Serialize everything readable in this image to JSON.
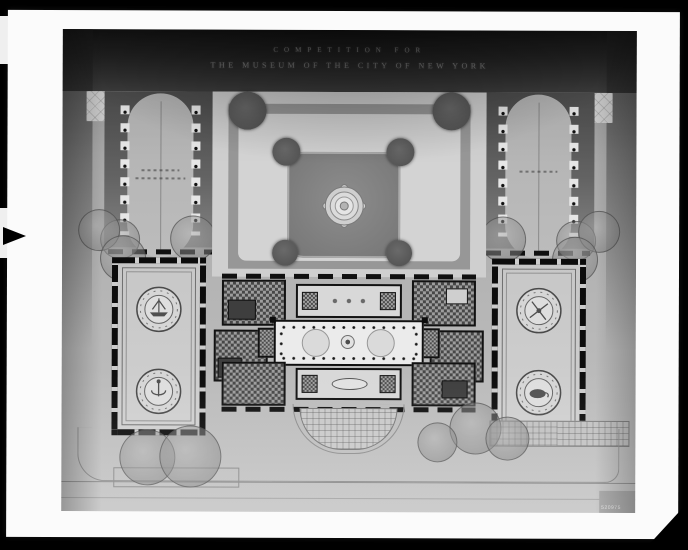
{
  "photo": {
    "title_line1": "COMPETITION FOR",
    "title_line2": "THE MUSEUM OF THE CITY OF NEW YORK",
    "catalog_number": "520975"
  },
  "palette": {
    "background": "#000000",
    "paper": "#fbfbfb",
    "title_band": "#1c1c1c",
    "title_text": "#787878",
    "photo_top": "#8e8e8e",
    "photo_bottom": "#c3c3c3",
    "court_lawn": "#7a7a7a",
    "walkway": "#d3d3d3",
    "planting_bed": "#4c4c4c",
    "wall_poche": "#0c0c0c"
  }
}
